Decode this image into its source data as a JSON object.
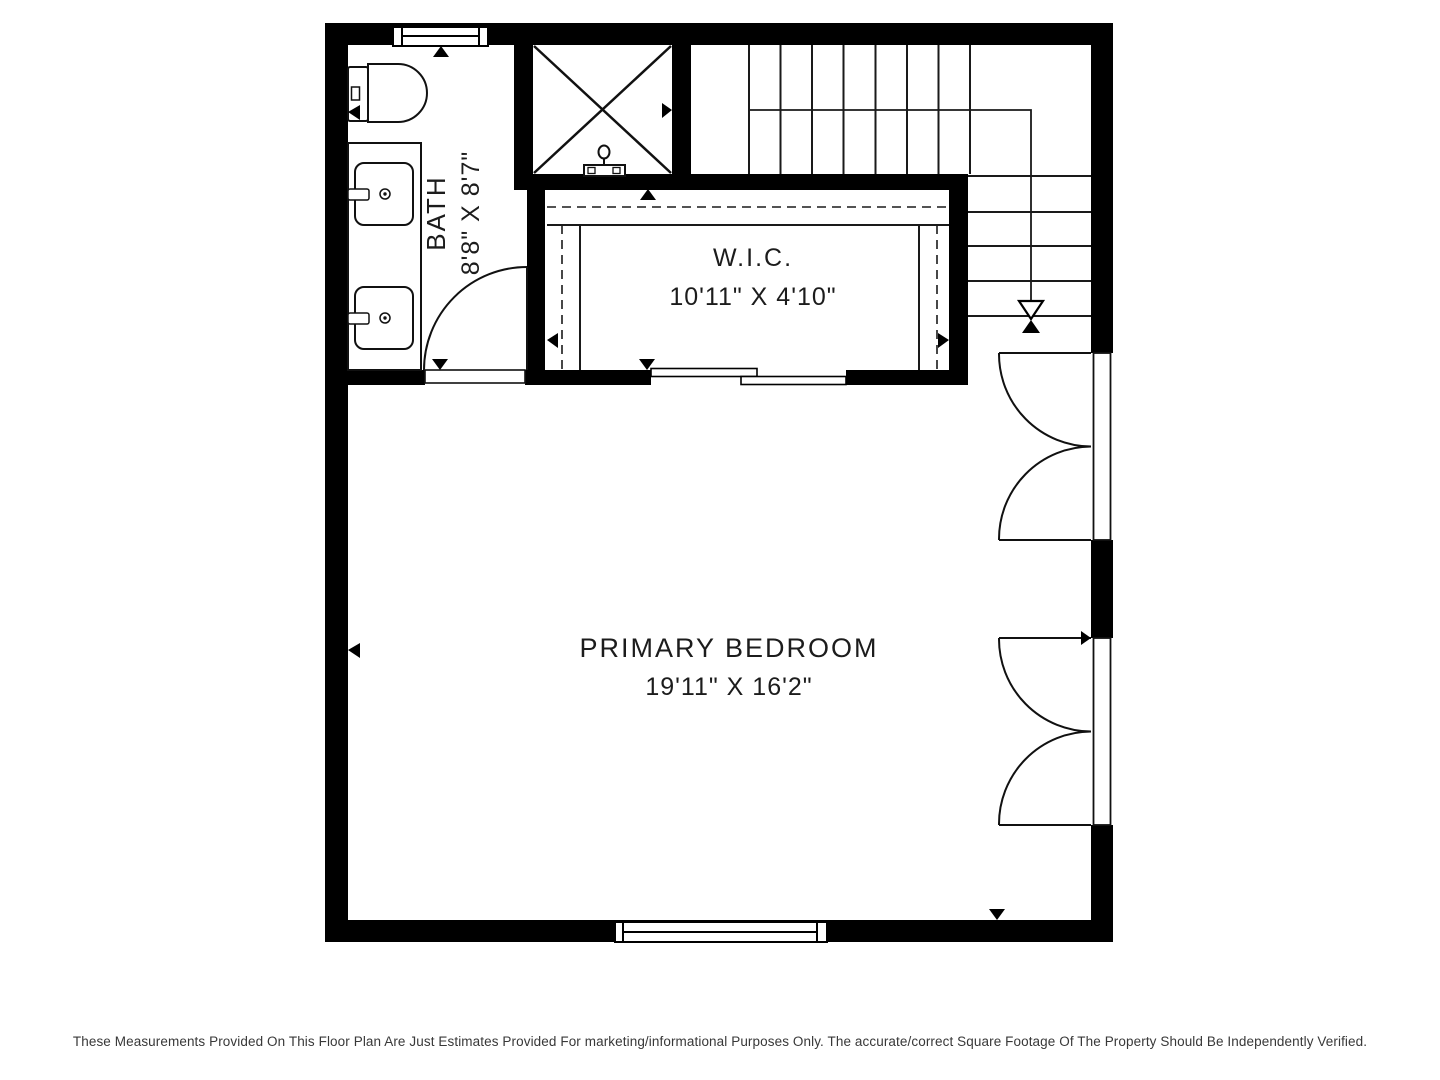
{
  "title": "Floor Plan",
  "rooms": {
    "bath": {
      "name": "BATH",
      "dimensions": "8'8\" X 8'7\""
    },
    "wic": {
      "name": "W.I.C.",
      "dimensions": "10'11\" X 4'10\""
    },
    "bedroom": {
      "name": "PRIMARY BEDROOM",
      "dimensions": "19'11\" X 16'2\""
    }
  },
  "footer": {
    "disclaimer": "These Measurements Provided On This Floor Plan Are Just Estimates Provided For marketing/informational Purposes Only. The accurate/correct Square Footage Of The Property Should Be Independently Verified."
  },
  "symbols": {
    "toilet": "toilet-top-view",
    "vanity": "double-sink-vanity",
    "shower": "crossed-box-shower",
    "stairs": "staircase-with-down-arrow",
    "bath_door": "swing-door-arc",
    "bedroom_doors": "double-french-doors",
    "closet_door": "bypass-sliding-door",
    "windows": "wall-window",
    "closet_rods": "dashed-hanging-rod-lines"
  },
  "colors": {
    "wall": "#000000",
    "line": "#1a1a1a",
    "label_text": "#1c1c1c",
    "disclaimer_text": "#383838",
    "background": "#ffffff"
  }
}
